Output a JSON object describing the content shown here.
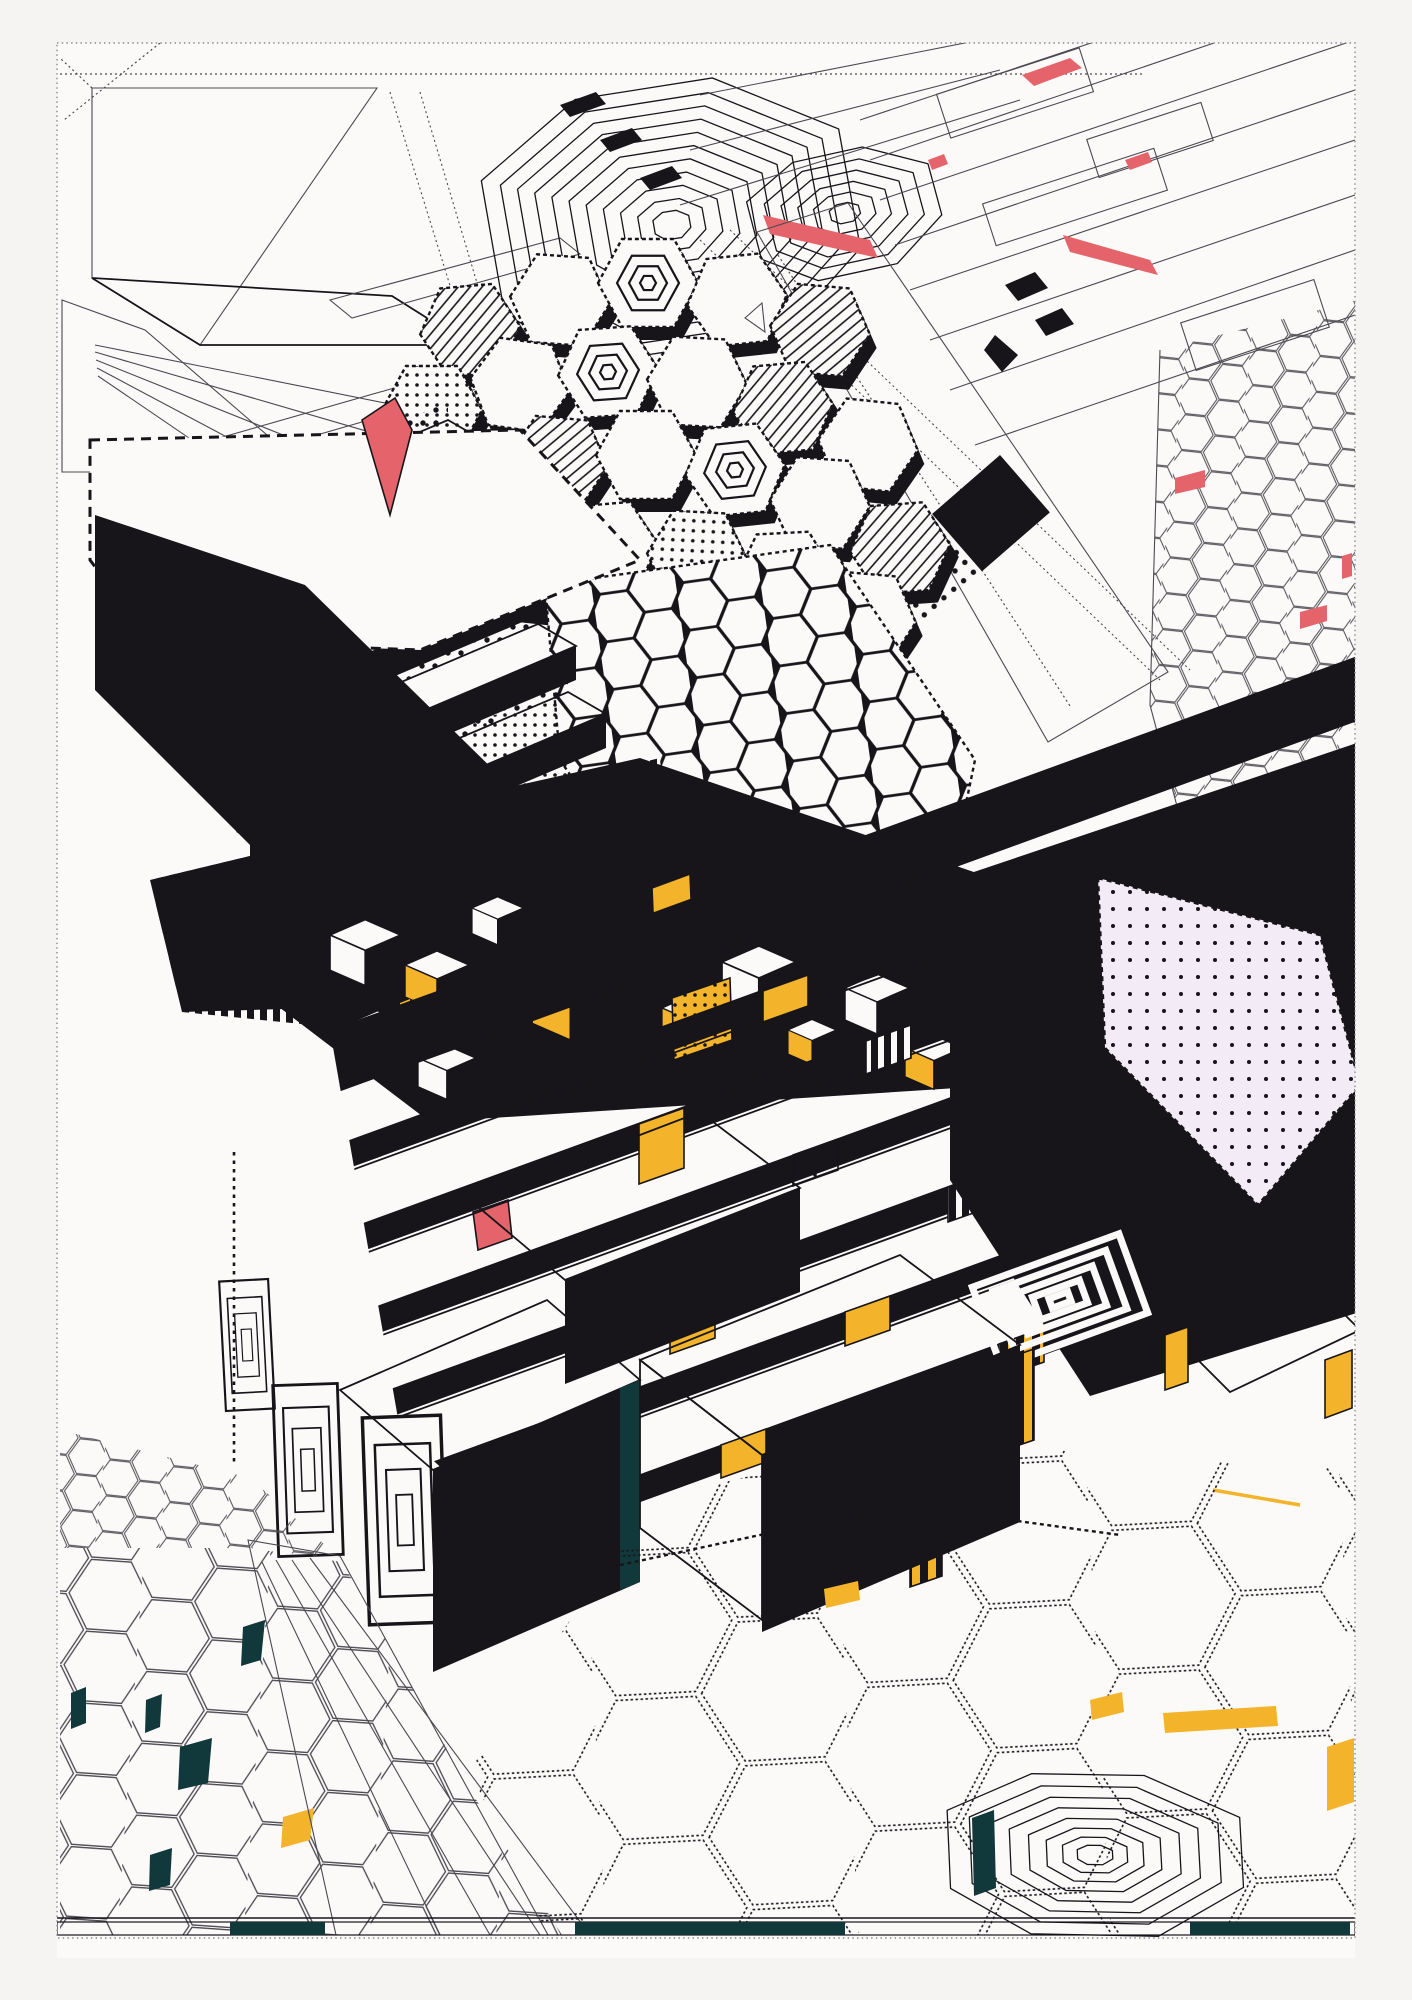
{
  "artwork": {
    "kind": "generative-isometric-city-print",
    "palette": {
      "paper": "#f6f4f2",
      "canvas": "#fcfaf9",
      "ink": "#17151a",
      "line": "#4b4950",
      "yellow": "#f3b42c",
      "red": "#e5646b",
      "teal": "#11393c",
      "pink": "#f3ebf5",
      "frame": "#8c8a90"
    },
    "regions": [
      "dotted-frame",
      "hatched-panels",
      "ladder-band",
      "fan-lines",
      "spiral-hexagon-large",
      "spiral-hexagon-small",
      "topright-linework",
      "hex-dome",
      "white-ramp",
      "honeycomb-slope",
      "striped-slab-rows",
      "vertical-stripe-wall",
      "central-black-band",
      "iso-cubes",
      "terrace-steps",
      "right-black-mass",
      "chevron-motif",
      "striped-boxes",
      "pink-dotted-field",
      "halftone-band",
      "right-hex-tower",
      "white-boxes",
      "door-motifs",
      "white-road",
      "left-hex-floor",
      "bottomright-hex-tiles",
      "spiral-heptagon-floor",
      "baseline-strip",
      "red-accents",
      "yellow-accents",
      "teal-accents"
    ]
  }
}
